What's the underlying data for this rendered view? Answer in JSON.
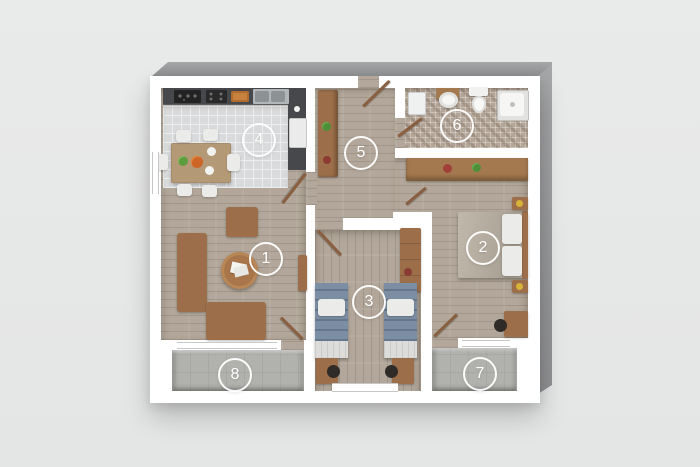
{
  "plan": {
    "rooms": [
      {
        "number": "1",
        "type": "living-room",
        "floor": "wood"
      },
      {
        "number": "2",
        "type": "bedroom-double",
        "floor": "wood"
      },
      {
        "number": "3",
        "type": "bedroom-twin",
        "floor": "wood"
      },
      {
        "number": "4",
        "type": "kitchen-dining",
        "floor": "tile"
      },
      {
        "number": "5",
        "type": "hallway",
        "floor": "wood"
      },
      {
        "number": "6",
        "type": "bathroom",
        "floor": "mosaic-tile"
      },
      {
        "number": "7",
        "type": "balcony",
        "floor": "concrete"
      },
      {
        "number": "8",
        "type": "balcony",
        "floor": "concrete"
      }
    ],
    "colors": {
      "bg": "#e9eaea",
      "wall": "#ffffff",
      "wood": "#b2a79a",
      "tile": "#d9dadb",
      "mosaic": "#b3a597",
      "balcony": "#b1b1ad",
      "woodf": "#9c6f4a",
      "counter": "#46484b",
      "blue": "#7c8ea3",
      "uph": "#ebebe9",
      "door": "#8a5f3f"
    }
  }
}
